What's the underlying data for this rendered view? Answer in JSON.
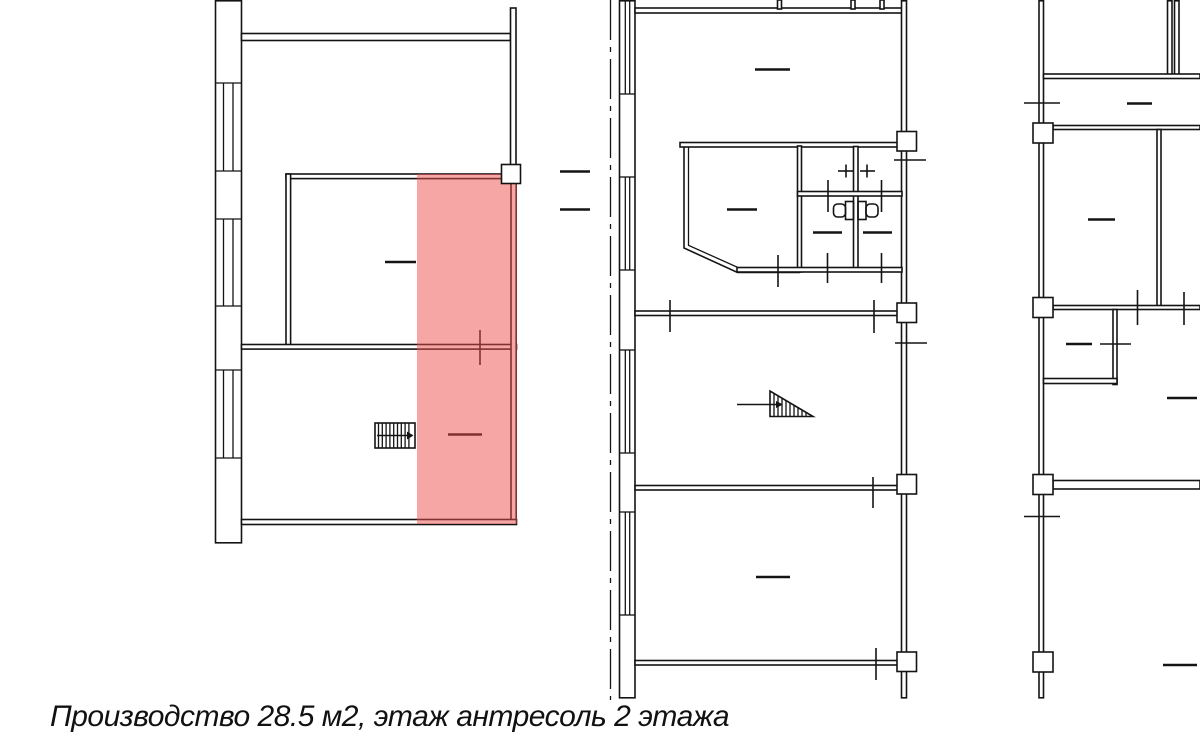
{
  "caption": {
    "text": "Производство 28.5 м2, этаж антресоль 2 этажа"
  },
  "highlight": {
    "fill_rgba": "rgba(240,77,77,0.5)",
    "unit_type": "Производство",
    "unit_area": "28.5 м2",
    "unit_floor": "этаж антресоль 2 этажа"
  },
  "plan": {
    "line_color": "#141414",
    "background": "#ffffff"
  }
}
